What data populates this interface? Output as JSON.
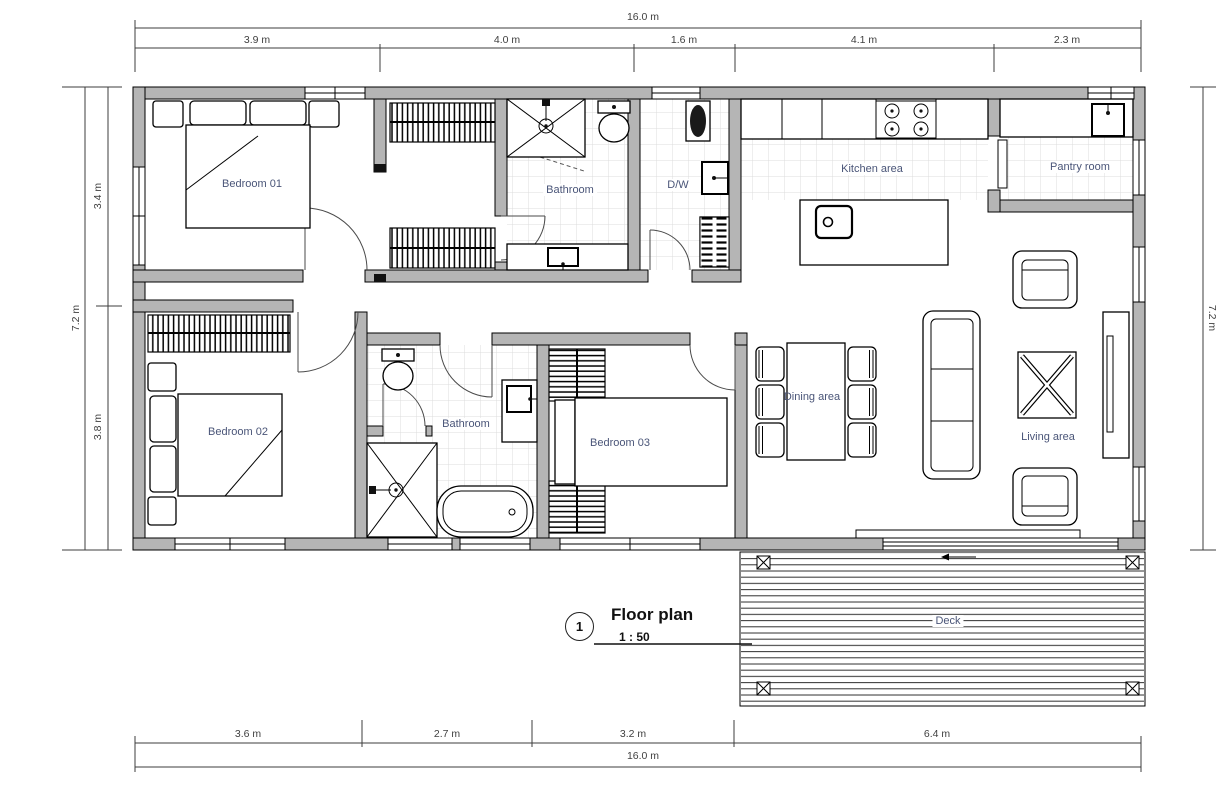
{
  "drawing": {
    "title": {
      "number": "1",
      "name": "Floor plan",
      "scale": "1 : 50"
    },
    "rooms": [
      {
        "id": "bedroom-01",
        "label": "Bedroom 01"
      },
      {
        "id": "bathroom-top",
        "label": "Bathroom"
      },
      {
        "id": "dw",
        "label": "D/W"
      },
      {
        "id": "kitchen",
        "label": "Kitchen area"
      },
      {
        "id": "pantry",
        "label": "Pantry room"
      },
      {
        "id": "bedroom-02",
        "label": "Bedroom 02"
      },
      {
        "id": "bathroom-bottom",
        "label": "Bathroom"
      },
      {
        "id": "bedroom-03",
        "label": "Bedroom 03"
      },
      {
        "id": "dining",
        "label": "Dining area"
      },
      {
        "id": "living",
        "label": "Living area"
      },
      {
        "id": "deck",
        "label": "Deck"
      }
    ],
    "dimensions": {
      "top_total": "16.0 m",
      "top_segments": [
        "3.9 m",
        "4.0 m",
        "1.6 m",
        "4.1 m",
        "2.3 m"
      ],
      "left_total": "7.2 m",
      "left_segments": [
        "3.4 m",
        "3.8 m"
      ],
      "right_total": "7.2 m",
      "bottom_segments": [
        "3.6 m",
        "2.7 m",
        "3.2 m",
        "6.4 m"
      ],
      "bottom_total": "16.0 m"
    },
    "colors": {
      "wall_fill": "#b5b5b5",
      "line": "#000000",
      "room_label": "#4a5578",
      "dimension_text": "#3f3f3f"
    }
  }
}
